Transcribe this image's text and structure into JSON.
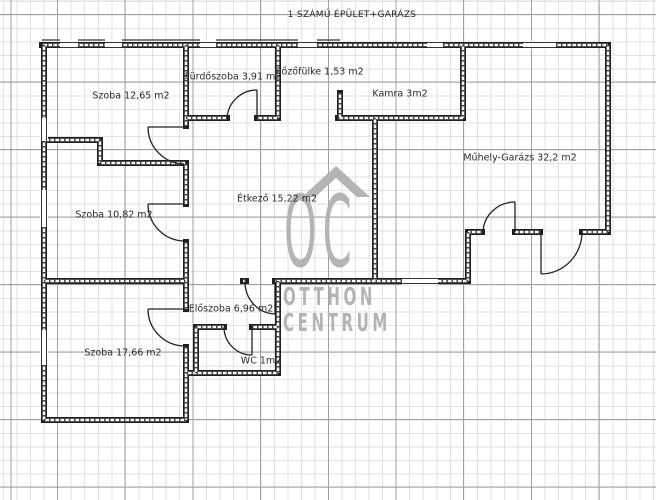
{
  "title": "1 SZÁMÚ ÉPÜLET+GARÁZS",
  "rooms": [
    {
      "id": "szoba-1",
      "label": "Szoba 12,65 m2"
    },
    {
      "id": "furdoszoba",
      "label": "Fürdőszoba 3,91 m2"
    },
    {
      "id": "fozofulke",
      "label": "Főzőfülke 1,53 m2"
    },
    {
      "id": "kamra",
      "label": "Kamra 3m2"
    },
    {
      "id": "muhely-garazs",
      "label": "Műhely-Garázs 32,2 m2"
    },
    {
      "id": "szoba-2",
      "label": "Szoba 10,82 m2"
    },
    {
      "id": "etkezo",
      "label": "Étkező 15,22 m2"
    },
    {
      "id": "eloszoba",
      "label": "Előszoba 6,96 m2"
    },
    {
      "id": "wc",
      "label": "WC 1m2"
    },
    {
      "id": "szoba-3",
      "label": "Szoba 17,66 m2"
    }
  ],
  "watermark": {
    "monogram": "OC",
    "line2": "OTTHON",
    "line3": "CENTRUM",
    "color": "#b4b4b4"
  },
  "colors": {
    "wall": "#1f1f1f",
    "grid_minor": "#e2e2e2",
    "grid_major": "#a0a0a0",
    "label_text": "#2b2b2b"
  }
}
